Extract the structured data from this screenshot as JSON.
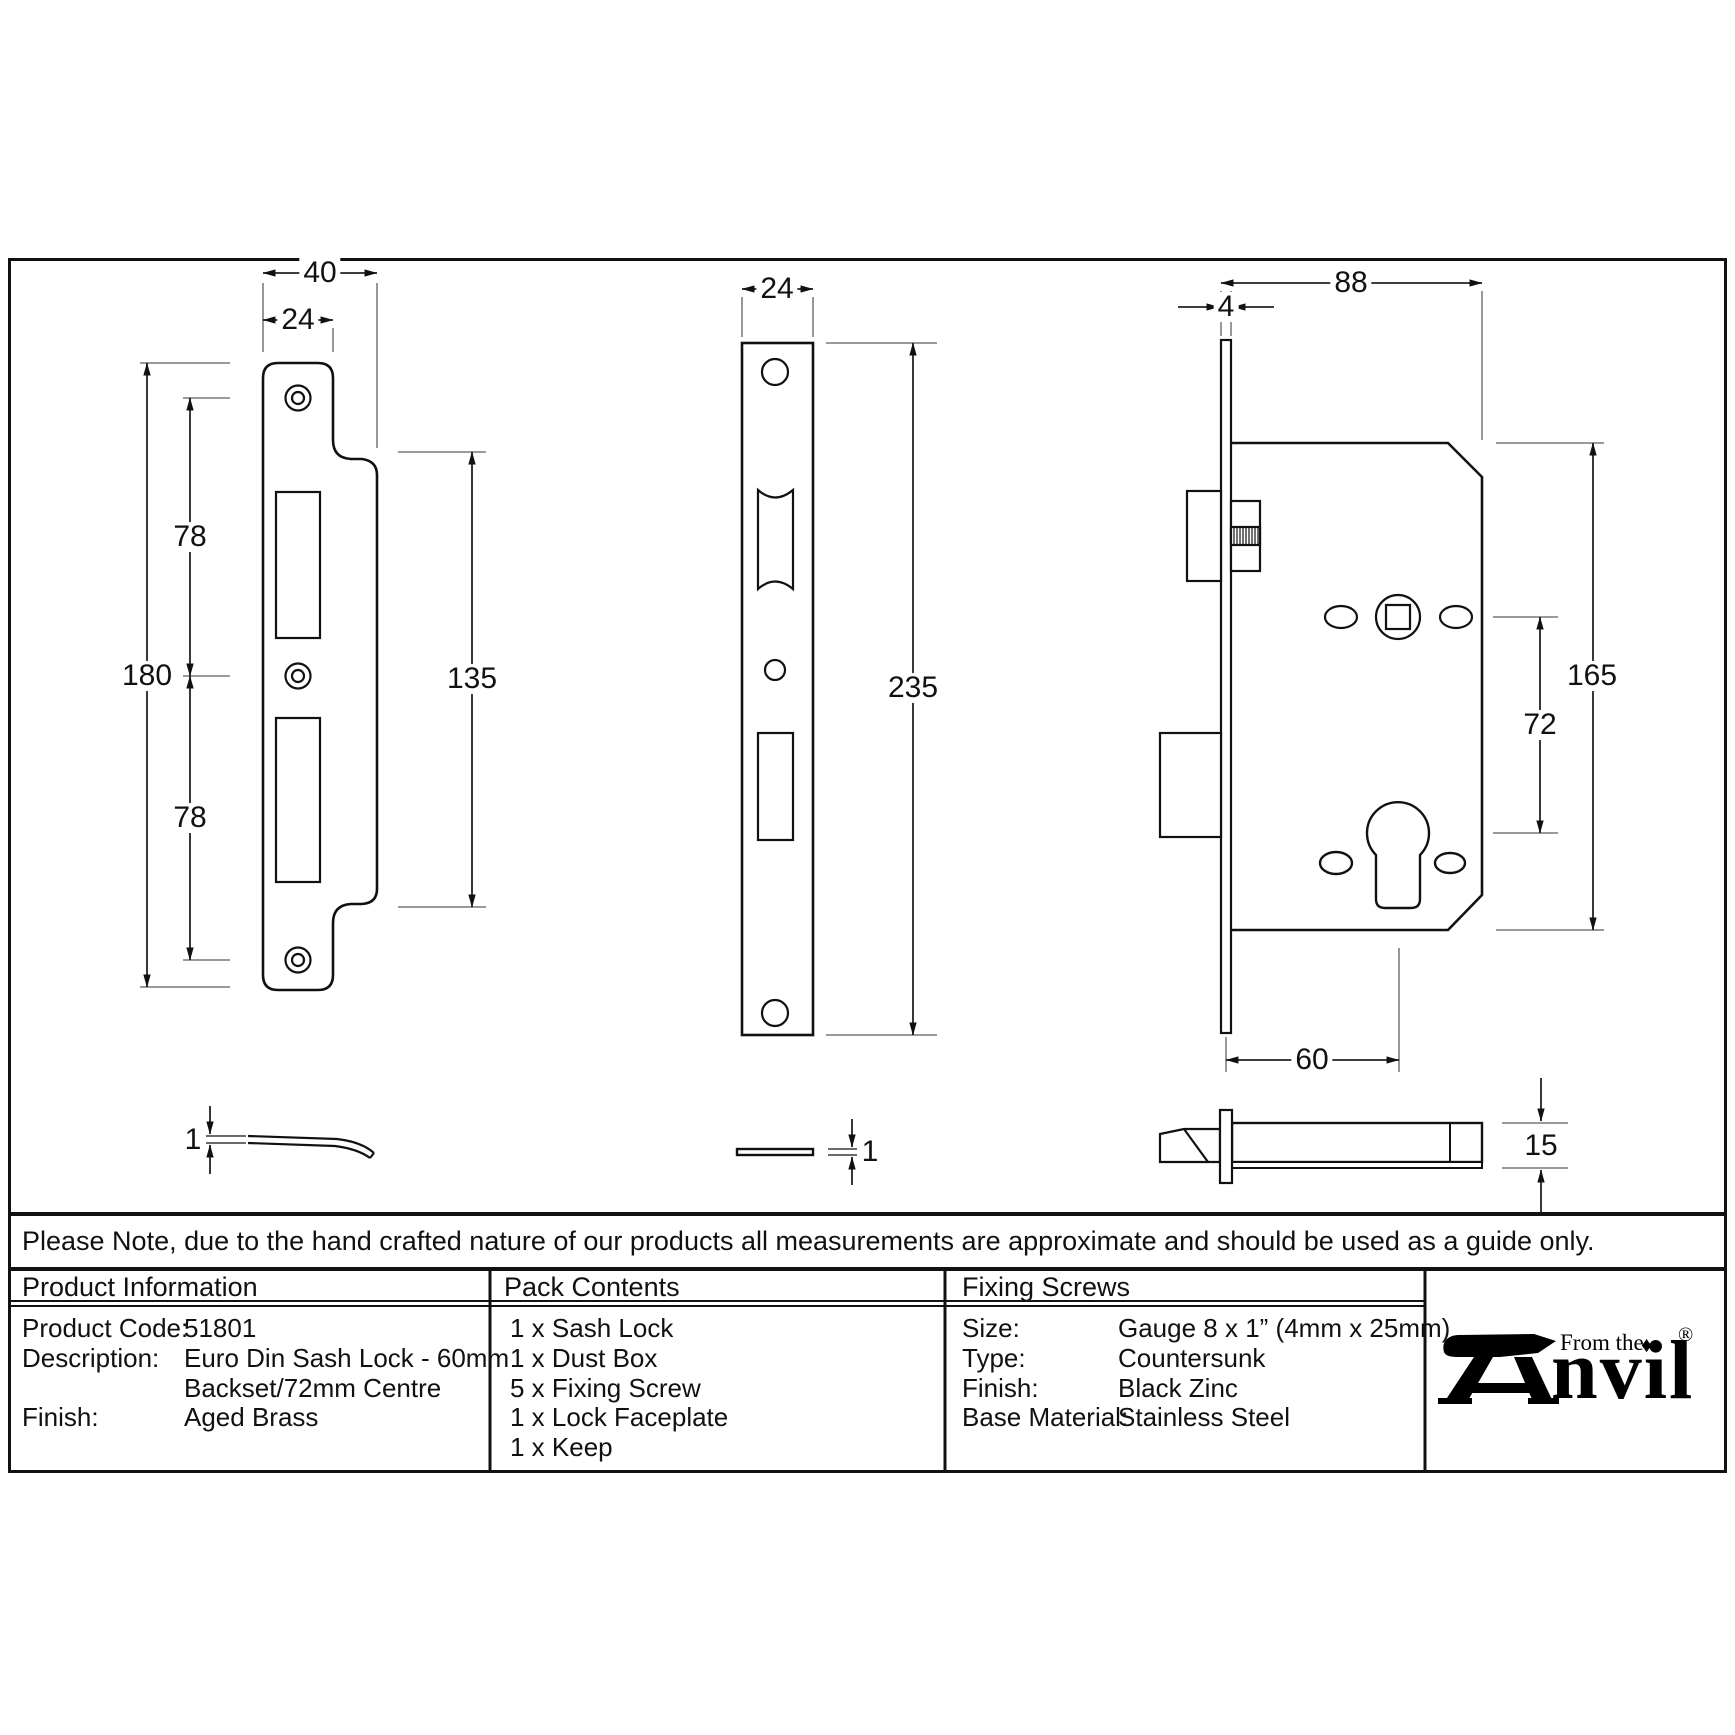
{
  "sheet": {
    "note": "Please Note, due to the hand crafted nature of our products all measurements are approximate and should be used as a guide only."
  },
  "dimensions": {
    "keep_front": {
      "overall_width": "40",
      "inner_width": "24",
      "overall_height": "180",
      "top_spacing": "78",
      "bottom_spacing": "78",
      "lip_height": "135"
    },
    "keep_side": {
      "thickness": "1"
    },
    "faceplate_front": {
      "width": "24",
      "height": "235"
    },
    "faceplate_side": {
      "thickness": "1"
    },
    "lock_front": {
      "body_width": "88",
      "faceplate_thickness": "4",
      "body_height": "165",
      "centres": "72",
      "backset": "60"
    },
    "lock_side": {
      "case_depth": "15"
    }
  },
  "table": {
    "product_information": {
      "header": "Product Information",
      "rows": [
        {
          "label": "Product Code:",
          "value": "51801"
        },
        {
          "label": "Description:",
          "value": "Euro Din Sash Lock - 60mm"
        },
        {
          "label": "",
          "value": "Backset/72mm Centre"
        },
        {
          "label": "Finish:",
          "value": "Aged Brass"
        }
      ]
    },
    "pack_contents": {
      "header": "Pack Contents",
      "items": [
        "1 x Sash Lock",
        "1 x Dust Box",
        "5 x Fixing Screw",
        "1 x Lock Faceplate",
        "1 x Keep"
      ]
    },
    "fixing_screws": {
      "header": "Fixing Screws",
      "rows": [
        {
          "label": "Size:",
          "value": "Gauge 8 x 1” (4mm x 25mm)"
        },
        {
          "label": "Type:",
          "value": "Countersunk"
        },
        {
          "label": "Finish:",
          "value": "Black Zinc"
        },
        {
          "label": "Base Material:",
          "value": "Stainless Steel"
        }
      ]
    }
  },
  "logo": {
    "from_the": "From the",
    "brand_suffix": "nvil",
    "diamond": "♦",
    "registered": "®"
  },
  "colors": {
    "ink": "#111111",
    "dim_line": "#222222",
    "extension_line": "#8c8c8c",
    "background": "#ffffff"
  }
}
